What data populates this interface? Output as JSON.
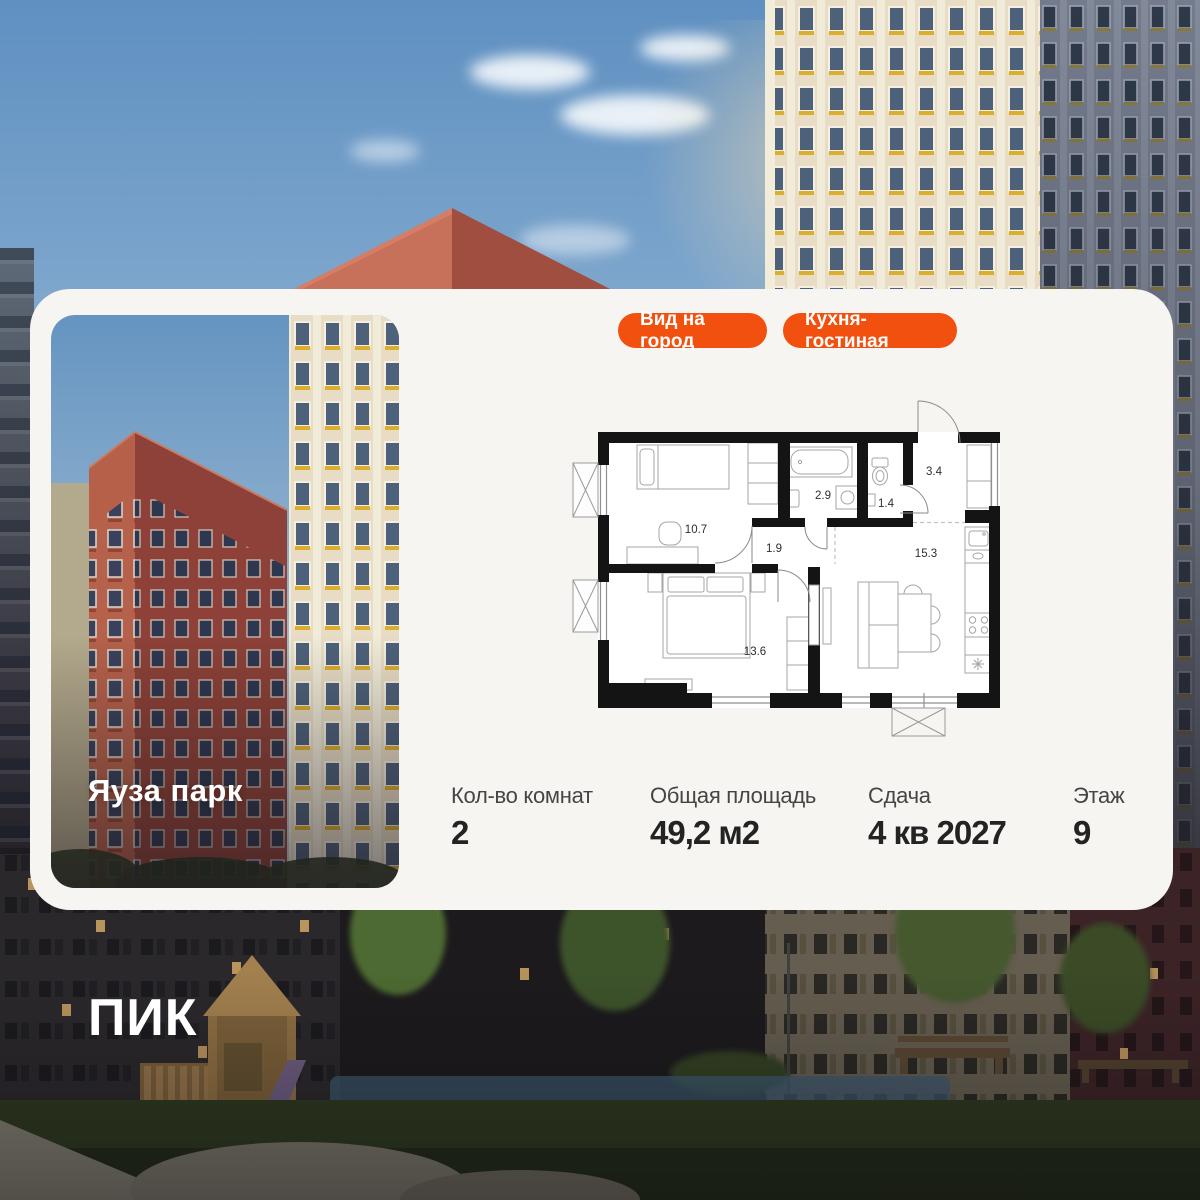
{
  "card": {
    "bg": "#f6f5f2",
    "project_name": "Яуза парк",
    "badge_color": "#F2500F",
    "badges": [
      {
        "label": "Вид на город"
      },
      {
        "label": "Кухня-гостиная"
      }
    ],
    "stats": [
      {
        "label": "Кол-во комнат",
        "value": "2"
      },
      {
        "label": "Общая площадь",
        "value": "49,2 м2"
      },
      {
        "label": "Сдача",
        "value": "4 кв 2027"
      },
      {
        "label": "Этаж",
        "value": "9"
      }
    ],
    "floorplan": {
      "room_areas": {
        "bedroom1": "10.7",
        "bathroom": "2.9",
        "wc": "1.4",
        "hallway": "3.4",
        "corridor": "1.9",
        "kitchen_living": "15.3",
        "bedroom2": "13.6"
      }
    }
  },
  "brand": {
    "logo_text": "ПИК"
  }
}
